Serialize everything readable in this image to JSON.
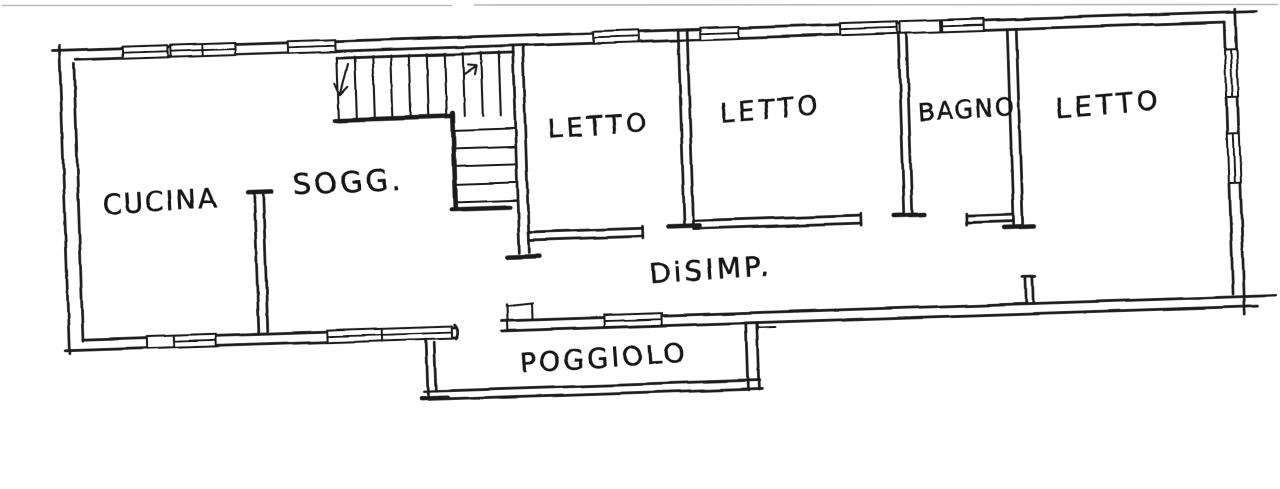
{
  "plan": {
    "rooms": [
      {
        "id": "cucina",
        "label": "CUCINA"
      },
      {
        "id": "soggiorno",
        "label": "SOGG."
      },
      {
        "id": "letto-1",
        "label": "LETTO"
      },
      {
        "id": "letto-2",
        "label": "LETTO"
      },
      {
        "id": "bagno",
        "label": "BAGNO"
      },
      {
        "id": "letto-3",
        "label": "LETTO"
      },
      {
        "id": "disimpegno",
        "label": "DiSIMP."
      },
      {
        "id": "poggiolo",
        "label": "POGGIOLO"
      }
    ],
    "colors": {
      "ink": "#1c1c1c",
      "paper": "#ffffff"
    }
  }
}
